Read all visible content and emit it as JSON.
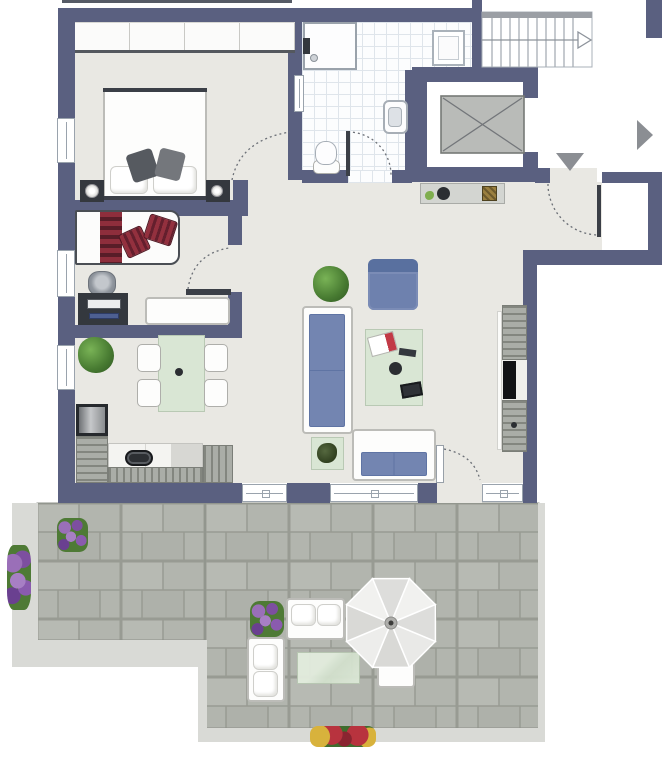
{
  "meta": {
    "kind": "apartment floor plan",
    "has_text_labels": false
  },
  "colors": {
    "wall": "#5a6080",
    "interior_floor": "#e9e8e3",
    "bathroom_tile_line": "#dfe5eb",
    "terrace_paver": "#b2b5ae",
    "terrace_paver_joint": "#989b93",
    "terrace_curb": "#d9dad6",
    "sofa_cushion_blue": "#7385b1",
    "table_green": "#d9e6d4",
    "pillow_red": "#93303e",
    "furniture_dark": "#34383e",
    "direction_arrow_gray": "#8b8e93"
  },
  "rooms": [
    {
      "name": "bedroom",
      "furniture": [
        "wardrobe",
        "double-bed",
        "pillows",
        "nightstand-left",
        "nightstand-right",
        "lamps"
      ]
    },
    {
      "name": "study-guest-room",
      "furniture": [
        "daybed",
        "striped-blanket",
        "red-pillows",
        "desk",
        "office-chair",
        "dresser"
      ]
    },
    {
      "name": "bathroom",
      "furniture": [
        "shower",
        "washing-machine",
        "wall-sink",
        "toilet"
      ]
    },
    {
      "name": "hallway",
      "furniture": [
        "sideboard",
        "bowl",
        "basket"
      ]
    },
    {
      "name": "open-living-dining-kitchen",
      "furniture": [
        "l-shaped-kitchen",
        "oven",
        "sink",
        "fridge",
        "dining-table",
        "four-chairs",
        "potted-plants",
        "armchair",
        "large-sofa",
        "coffee-table",
        "two-seat-sofa",
        "side-table",
        "tv-sideboard"
      ]
    },
    {
      "name": "stairwell-and-elevator",
      "furniture": [
        "staircase",
        "direction-arrows",
        "elevator-car"
      ]
    },
    {
      "name": "terrace",
      "furniture": [
        "paver-flooring",
        "flower-planters",
        "outdoor-sofas",
        "outdoor-table",
        "parasol",
        "bench",
        "flower-border"
      ]
    }
  ],
  "elements": [
    {
      "n": "floor-main",
      "c": "floor",
      "x": 75,
      "y": 22,
      "w": 397,
      "h": 461
    },
    {
      "n": "floor-living-east",
      "c": "floor",
      "x": 412,
      "y": 250,
      "w": 111,
      "h": 233
    },
    {
      "n": "floor-hallway-entry",
      "c": "floor",
      "x": 412,
      "y": 182,
      "w": 190,
      "h": 68
    },
    {
      "n": "entry-door-opening",
      "c": "floor",
      "x": 550,
      "y": 168,
      "w": 47,
      "h": 15
    },
    {
      "n": "door-threshold-terrace",
      "c": "floor",
      "x": 437,
      "y": 483,
      "w": 45,
      "h": 20
    },
    {
      "n": "floor-bathroom-upper",
      "c": "tilefloor",
      "x": 302,
      "y": 22,
      "w": 170,
      "h": 48
    },
    {
      "n": "floor-bathroom",
      "c": "tilefloor",
      "x": 302,
      "y": 22,
      "w": 106,
      "h": 148
    },
    {
      "n": "bath-door-opening",
      "c": "tilefloor",
      "x": 348,
      "y": 170,
      "w": 44,
      "h": 13
    },
    {
      "n": "elevator-interior",
      "c": "whitebox",
      "x": 427,
      "y": 82,
      "w": 96,
      "h": 85
    },
    {
      "n": "terrace-curb-west",
      "c": "curb",
      "x": 12,
      "y": 503,
      "w": 26,
      "h": 164
    },
    {
      "n": "terrace-curb-southwest",
      "c": "curb",
      "x": 12,
      "y": 640,
      "w": 195,
      "h": 27
    },
    {
      "n": "terrace-curb-step",
      "c": "curb",
      "x": 198,
      "y": 640,
      "w": 9,
      "h": 100
    },
    {
      "n": "terrace-curb-south",
      "c": "curb",
      "x": 198,
      "y": 728,
      "w": 347,
      "h": 14
    },
    {
      "n": "terrace-curb-east",
      "c": "curb",
      "x": 538,
      "y": 503,
      "w": 7,
      "h": 239
    },
    {
      "n": "roof-edge-line",
      "c": "edgeline",
      "x": 62,
      "y": 0,
      "w": 230,
      "h": 3
    },
    {
      "n": "wall-north",
      "c": "wall",
      "x": 58,
      "y": 8,
      "w": 424,
      "h": 14
    },
    {
      "n": "wall-west",
      "c": "wall",
      "x": 58,
      "y": 22,
      "w": 17,
      "h": 481
    },
    {
      "n": "wall-south-1",
      "c": "wall",
      "x": 58,
      "y": 483,
      "w": 184,
      "h": 20
    },
    {
      "n": "wall-south-2",
      "c": "wall",
      "x": 287,
      "y": 483,
      "w": 43,
      "h": 20
    },
    {
      "n": "wall-south-3",
      "c": "wall",
      "x": 418,
      "y": 483,
      "w": 19,
      "h": 20
    },
    {
      "n": "wall-south-4",
      "c": "wall",
      "x": 523,
      "y": 483,
      "w": 14,
      "h": 20
    },
    {
      "n": "wall-east-living",
      "c": "wall",
      "x": 523,
      "y": 250,
      "w": 14,
      "h": 233
    },
    {
      "n": "wall-hall-south",
      "c": "wall",
      "x": 537,
      "y": 250,
      "w": 125,
      "h": 15
    },
    {
      "n": "wall-east-entry",
      "c": "wall",
      "x": 648,
      "y": 172,
      "w": 14,
      "h": 93
    },
    {
      "n": "wall-entry-north-right",
      "c": "wall",
      "x": 602,
      "y": 172,
      "w": 46,
      "h": 11
    },
    {
      "n": "wall-entry-north-left",
      "c": "wall",
      "x": 535,
      "y": 168,
      "w": 15,
      "h": 15
    },
    {
      "n": "wall-elevator-north",
      "c": "wall",
      "x": 412,
      "y": 67,
      "w": 126,
      "h": 15
    },
    {
      "n": "wall-elevator-west",
      "c": "wall",
      "x": 405,
      "y": 70,
      "w": 22,
      "h": 112
    },
    {
      "n": "wall-elevator-east-a",
      "c": "wall",
      "x": 523,
      "y": 82,
      "w": 15,
      "h": 16
    },
    {
      "n": "wall-elevator-east-b",
      "c": "wall",
      "x": 523,
      "y": 152,
      "w": 15,
      "h": 15
    },
    {
      "n": "wall-elevator-south",
      "c": "wall",
      "x": 412,
      "y": 167,
      "w": 126,
      "h": 15
    },
    {
      "n": "wall-stairwell-west",
      "c": "wall",
      "x": 472,
      "y": 0,
      "w": 10,
      "h": 67
    },
    {
      "n": "wall-northeast-corner",
      "c": "wall",
      "x": 646,
      "y": 0,
      "w": 16,
      "h": 38
    },
    {
      "n": "wall-bedroom-bath",
      "c": "wall",
      "x": 288,
      "y": 8,
      "w": 14,
      "h": 172
    },
    {
      "n": "wall-bath-south-a",
      "c": "wall",
      "x": 302,
      "y": 170,
      "w": 46,
      "h": 13
    },
    {
      "n": "wall-bath-south-b",
      "c": "wall",
      "x": 392,
      "y": 170,
      "w": 20,
      "h": 13
    },
    {
      "n": "wall-bedroom-south",
      "c": "wall",
      "x": 58,
      "y": 200,
      "w": 175,
      "h": 16
    },
    {
      "n": "wall-bedroom-stub",
      "c": "wall",
      "x": 233,
      "y": 180,
      "w": 15,
      "h": 36
    },
    {
      "n": "wall-room2-east-a",
      "c": "wall",
      "x": 228,
      "y": 200,
      "w": 14,
      "h": 45
    },
    {
      "n": "wall-room2-east-b",
      "c": "wall",
      "x": 228,
      "y": 292,
      "w": 14,
      "h": 46
    },
    {
      "n": "wall-room2-south",
      "c": "wall",
      "x": 58,
      "y": 325,
      "w": 184,
      "h": 13
    },
    {
      "n": "window-bedroom-west",
      "c": "win win-v",
      "x": 57,
      "y": 118,
      "w": 18,
      "h": 45
    },
    {
      "n": "window-room2-west",
      "c": "win win-v",
      "x": 57,
      "y": 250,
      "w": 18,
      "h": 47
    },
    {
      "n": "window-living-west",
      "c": "win win-v",
      "x": 57,
      "y": 345,
      "w": 18,
      "h": 45
    },
    {
      "n": "window-living-south-1",
      "c": "win win-h",
      "x": 242,
      "y": 484,
      "w": 45,
      "h": 18
    },
    {
      "n": "window-living-south-2",
      "c": "win win-h",
      "x": 330,
      "y": 484,
      "w": 88,
      "h": 18
    },
    {
      "n": "window-living-south-3",
      "c": "win win-h",
      "x": 482,
      "y": 484,
      "w": 41,
      "h": 18
    },
    {
      "n": "glass-panel-bathroom",
      "c": "win win-v",
      "x": 294,
      "y": 75,
      "w": 10,
      "h": 37
    },
    {
      "n": "bedroom-wardrobe",
      "c": "wardrobe",
      "x": 75,
      "y": 22,
      "w": 220,
      "h": 31
    },
    {
      "n": "double-bed",
      "c": "furn-white",
      "x": 103,
      "y": 88,
      "w": 104,
      "h": 112
    },
    {
      "n": "bed-foot-line",
      "c": "darkline",
      "x": 103,
      "y": 88,
      "w": 104,
      "h": 4
    },
    {
      "n": "bed-head-line",
      "c": "darkline",
      "x": 103,
      "y": 196,
      "w": 104,
      "h": 4
    },
    {
      "n": "bed-pillow-left",
      "c": "pillow",
      "x": 110,
      "y": 166,
      "w": 38,
      "h": 28
    },
    {
      "n": "bed-pillow-right",
      "c": "pillow",
      "x": 153,
      "y": 166,
      "w": 44,
      "h": 28
    },
    {
      "n": "bed-cushion-left",
      "c": "cushion-dark",
      "x": 129,
      "y": 151,
      "w": 27,
      "h": 29,
      "rot": -18
    },
    {
      "n": "bed-cushion-right",
      "c": "cushion-dark2",
      "x": 157,
      "y": 150,
      "w": 26,
      "h": 29,
      "rot": 14
    },
    {
      "n": "nightstand-left",
      "c": "furn-dark",
      "x": 80,
      "y": 180,
      "w": 24,
      "h": 22
    },
    {
      "n": "nightstand-lamp-left",
      "c": "lamp",
      "x": 85,
      "y": 184,
      "w": 14,
      "h": 14
    },
    {
      "n": "nightstand-right",
      "c": "furn-dark",
      "x": 206,
      "y": 180,
      "w": 24,
      "h": 22
    },
    {
      "n": "nightstand-lamp-right",
      "c": "lamp",
      "x": 211,
      "y": 185,
      "w": 12,
      "h": 12
    },
    {
      "n": "daybed",
      "c": "daybed",
      "x": 75,
      "y": 210,
      "w": 105,
      "h": 55
    },
    {
      "n": "daybed-blanket",
      "c": "blanket",
      "x": 100,
      "y": 212,
      "w": 22,
      "h": 51
    },
    {
      "n": "daybed-pillow-1",
      "c": "pillow-red",
      "x": 122,
      "y": 229,
      "w": 25,
      "h": 26,
      "rot": -25
    },
    {
      "n": "daybed-pillow-2",
      "c": "pillow-red",
      "x": 146,
      "y": 217,
      "w": 29,
      "h": 26,
      "rot": 18
    },
    {
      "n": "office-chair",
      "c": "chair-office",
      "x": 88,
      "y": 271,
      "w": 28,
      "h": 25
    },
    {
      "n": "desk",
      "c": "furn-dark",
      "x": 78,
      "y": 293,
      "w": 50,
      "h": 32
    },
    {
      "n": "desk-monitor",
      "c": "monitor",
      "x": 87,
      "y": 299,
      "w": 34,
      "h": 10
    },
    {
      "n": "desk-tablet",
      "c": "tabletb",
      "x": 89,
      "y": 313,
      "w": 30,
      "h": 6
    },
    {
      "n": "room2-dresser",
      "c": "furn-white",
      "x": 145,
      "y": 297,
      "w": 85,
      "h": 28
    },
    {
      "n": "door-leaf-room2",
      "c": "darkline",
      "x": 186,
      "y": 289,
      "w": 45,
      "h": 6
    },
    {
      "n": "kitchen-oven",
      "c": "oven",
      "x": 76,
      "y": 404,
      "w": 32,
      "h": 32
    },
    {
      "n": "kitchen-cabinet-west",
      "c": "stripes-h",
      "x": 76,
      "y": 436,
      "w": 32,
      "h": 47
    },
    {
      "n": "kitchen-counter",
      "c": "counter",
      "x": 108,
      "y": 443,
      "w": 95,
      "h": 25
    },
    {
      "n": "kitchen-sink",
      "c": "sink",
      "x": 125,
      "y": 450,
      "w": 28,
      "h": 16
    },
    {
      "n": "kitchen-cabinet-south",
      "c": "stripes-v",
      "x": 108,
      "y": 467,
      "w": 95,
      "h": 16
    },
    {
      "n": "kitchen-fridge",
      "c": "stripes-v",
      "x": 203,
      "y": 445,
      "w": 30,
      "h": 38
    },
    {
      "n": "dining-plant",
      "c": "plant",
      "x": 78,
      "y": 337,
      "w": 36,
      "h": 36
    },
    {
      "n": "dining-table",
      "c": "green",
      "x": 158,
      "y": 335,
      "w": 47,
      "h": 77
    },
    {
      "n": "dining-table-center",
      "c": "dot",
      "x": 175,
      "y": 368,
      "w": 8,
      "h": 8
    },
    {
      "n": "dining-chair-nw",
      "c": "chair",
      "x": 137,
      "y": 344,
      "w": 24,
      "h": 28
    },
    {
      "n": "dining-chair-sw",
      "c": "chair",
      "x": 137,
      "y": 379,
      "w": 24,
      "h": 28
    },
    {
      "n": "dining-chair-ne",
      "c": "chair",
      "x": 204,
      "y": 344,
      "w": 24,
      "h": 28
    },
    {
      "n": "dining-chair-se",
      "c": "chair",
      "x": 204,
      "y": 379,
      "w": 24,
      "h": 28
    },
    {
      "n": "living-plant",
      "c": "plant",
      "x": 313,
      "y": 266,
      "w": 36,
      "h": 36
    },
    {
      "n": "armchair",
      "c": "armchair",
      "x": 368,
      "y": 259,
      "w": 50,
      "h": 51
    },
    {
      "n": "sofa-large",
      "c": "furn-white",
      "x": 302,
      "y": 306,
      "w": 51,
      "h": 128
    },
    {
      "n": "sofa-large-cushions",
      "c": "cush",
      "x": 309,
      "y": 314,
      "w": 36,
      "h": 113
    },
    {
      "n": "coffee-table",
      "c": "green",
      "x": 365,
      "y": 329,
      "w": 58,
      "h": 77
    },
    {
      "n": "coffee-table-magazine",
      "c": "mag",
      "x": 369,
      "y": 334,
      "w": 27,
      "h": 20,
      "rot": -15
    },
    {
      "n": "coffee-table-remote",
      "c": "furn-dark",
      "x": 399,
      "y": 349,
      "w": 17,
      "h": 7,
      "rot": 8
    },
    {
      "n": "coffee-table-cup",
      "c": "dot",
      "x": 389,
      "y": 362,
      "w": 13,
      "h": 13
    },
    {
      "n": "coffee-table-tablet",
      "c": "tablet2",
      "x": 401,
      "y": 383,
      "w": 21,
      "h": 14,
      "rot": -10
    },
    {
      "n": "side-table",
      "c": "green",
      "x": 311,
      "y": 437,
      "w": 33,
      "h": 33
    },
    {
      "n": "side-table-plant",
      "c": "plant-dark",
      "x": 317,
      "y": 443,
      "w": 20,
      "h": 20
    },
    {
      "n": "sofa-two-seat",
      "c": "furn-white",
      "x": 352,
      "y": 429,
      "w": 84,
      "h": 52
    },
    {
      "n": "sofa-two-seat-cushions",
      "c": "cush2",
      "x": 361,
      "y": 452,
      "w": 66,
      "h": 24
    },
    {
      "n": "tv-wall-shelf",
      "c": "shelfw",
      "x": 497,
      "y": 311,
      "w": 5,
      "h": 139
    },
    {
      "n": "tv-sideboard-upper",
      "c": "stripes-h",
      "x": 502,
      "y": 305,
      "w": 25,
      "h": 55
    },
    {
      "n": "tv-sideboard-shelf",
      "c": "shelf",
      "x": 502,
      "y": 360,
      "w": 25,
      "h": 40
    },
    {
      "n": "tv-screen",
      "c": "tvc",
      "x": 503,
      "y": 361,
      "w": 13,
      "h": 38
    },
    {
      "n": "tv-sideboard-lower",
      "c": "stripes-h",
      "x": 502,
      "y": 400,
      "w": 25,
      "h": 52
    },
    {
      "n": "tv-sideboard-knob",
      "c": "dot",
      "x": 511,
      "y": 422,
      "w": 6,
      "h": 6
    },
    {
      "n": "hall-sideboard",
      "c": "gray",
      "x": 420,
      "y": 183,
      "w": 85,
      "h": 21
    },
    {
      "n": "hall-sideboard-bowl",
      "c": "dot",
      "x": 437,
      "y": 187,
      "w": 13,
      "h": 13
    },
    {
      "n": "hall-sideboard-deco",
      "c": "deco-green",
      "x": 425,
      "y": 191,
      "w": 9,
      "h": 9
    },
    {
      "n": "hall-sideboard-basket",
      "c": "basket",
      "x": 482,
      "y": 186,
      "w": 15,
      "h": 15
    },
    {
      "n": "shower",
      "c": "shower",
      "x": 303,
      "y": 22,
      "w": 54,
      "h": 48
    },
    {
      "n": "shower-fixture",
      "c": "furn-dark",
      "x": 303,
      "y": 38,
      "w": 7,
      "h": 16
    },
    {
      "n": "shower-drain",
      "c": "drain",
      "x": 310,
      "y": 54,
      "w": 8,
      "h": 8
    },
    {
      "n": "washing-machine",
      "c": "washer",
      "x": 432,
      "y": 30,
      "w": 33,
      "h": 36
    },
    {
      "n": "bathroom-sink",
      "c": "bsink",
      "x": 383,
      "y": 100,
      "w": 25,
      "h": 34
    },
    {
      "n": "bathroom-sink-basin",
      "c": "basin",
      "x": 388,
      "y": 107,
      "w": 14,
      "h": 20
    },
    {
      "n": "toilet-tank",
      "c": "chair",
      "x": 313,
      "y": 160,
      "w": 27,
      "h": 14
    },
    {
      "n": "toilet-bowl",
      "c": "bowl",
      "x": 315,
      "y": 141,
      "w": 22,
      "h": 24
    },
    {
      "n": "door-leaf-bathroom",
      "c": "darkline",
      "x": 346,
      "y": 131,
      "w": 4,
      "h": 45
    },
    {
      "n": "door-leaf-entry",
      "c": "darkline",
      "x": 597,
      "y": 185,
      "w": 4,
      "h": 52
    },
    {
      "n": "door-leaf-terrace",
      "c": "leafw",
      "x": 436,
      "y": 445,
      "w": 8,
      "h": 38
    },
    {
      "n": "terrace-planter-northwest",
      "c": "flowers",
      "x": 57,
      "y": 518,
      "w": 31,
      "h": 34
    },
    {
      "n": "terrace-flowers-west",
      "c": "flowers",
      "x": 7,
      "y": 545,
      "w": 24,
      "h": 65
    },
    {
      "n": "terrace-planter-middle",
      "c": "flowers",
      "x": 250,
      "y": 601,
      "w": 34,
      "h": 36
    },
    {
      "n": "outdoor-sofa-north",
      "c": "furn-white",
      "x": 286,
      "y": 598,
      "w": 59,
      "h": 42
    },
    {
      "n": "outdoor-sofa-north-cushion-1",
      "c": "pillow",
      "x": 291,
      "y": 604,
      "w": 25,
      "h": 22
    },
    {
      "n": "outdoor-sofa-north-cushion-2",
      "c": "pillow",
      "x": 317,
      "y": 604,
      "w": 24,
      "h": 22
    },
    {
      "n": "outdoor-sofa-west",
      "c": "furn-white",
      "x": 247,
      "y": 637,
      "w": 38,
      "h": 65
    },
    {
      "n": "outdoor-sofa-west-cushion-1",
      "c": "pillow",
      "x": 253,
      "y": 644,
      "w": 25,
      "h": 26
    },
    {
      "n": "outdoor-sofa-west-cushion-2",
      "c": "pillow",
      "x": 253,
      "y": 671,
      "w": 25,
      "h": 26
    },
    {
      "n": "outdoor-table",
      "c": "outtable",
      "x": 297,
      "y": 652,
      "w": 63,
      "h": 32
    },
    {
      "n": "outdoor-bench",
      "c": "furn-white",
      "x": 377,
      "y": 655,
      "w": 38,
      "h": 33
    },
    {
      "n": "terrace-flowers-south",
      "c": "flowers-mixed",
      "x": 310,
      "y": 726,
      "w": 66,
      "h": 21
    }
  ]
}
